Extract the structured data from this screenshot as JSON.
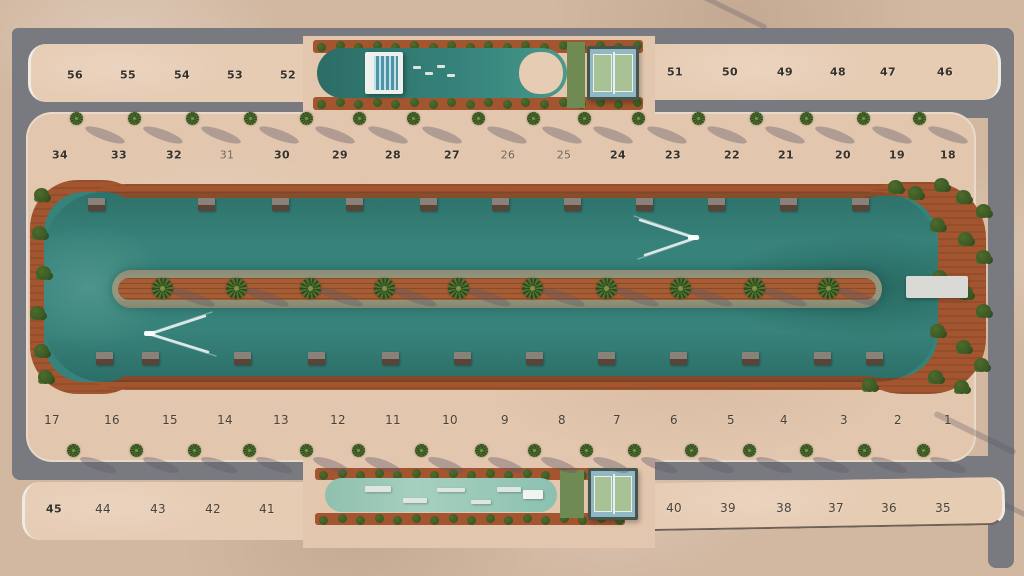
{
  "site": {
    "description": "aerial master plan of a lagoon resort community with numbered lots",
    "colors": {
      "sand_outer": "#d2b8a1",
      "sand_block": "#e7ccb4",
      "sand_strip": "#e2c6ad",
      "road": "#797a80",
      "path": "#bdbec2",
      "curb": "#efece6",
      "deck": "#a2552f",
      "water": "#37827a",
      "island_edge": "#95967f",
      "island_core": "#a65d33",
      "palm_dark": "#2c491f",
      "palm_light": "#55722f",
      "shrub_dark": "#32501f",
      "shrub_light": "#4e6c2c",
      "lawn": "#6f8a52",
      "court_blue": "#8fb8c4",
      "court_green": "#a9c295",
      "court_line": "#e9f1ef",
      "court_frame": "#46544c",
      "dock_top": "#8a8278",
      "dock_base": "#5a4337",
      "pier": "#d9d9d5",
      "wake": "#ffffff",
      "wakepool": "#97c7b6",
      "num_dark": "#36322c",
      "num_mid": "#4a4138",
      "num_soft": "#6e6257",
      "shadow": "rgba(95,90,102,0.38)"
    },
    "lot_rows": [
      {
        "name": "north-outer-west",
        "style": "bold",
        "y": 75,
        "lots": [
          {
            "n": "56",
            "x": 75
          },
          {
            "n": "55",
            "x": 128
          },
          {
            "n": "54",
            "x": 182
          },
          {
            "n": "53",
            "x": 235
          },
          {
            "n": "52",
            "x": 288
          }
        ]
      },
      {
        "name": "north-outer-east",
        "style": "bold",
        "y": 72,
        "lots": [
          {
            "n": "51",
            "x": 675
          },
          {
            "n": "50",
            "x": 730
          },
          {
            "n": "49",
            "x": 785
          },
          {
            "n": "48",
            "x": 838
          },
          {
            "n": "47",
            "x": 888
          },
          {
            "n": "46",
            "x": 945
          }
        ]
      },
      {
        "name": "north-inner",
        "style": "bold",
        "y": 155,
        "lots": [
          {
            "n": "34",
            "x": 60
          },
          {
            "n": "33",
            "x": 119
          },
          {
            "n": "32",
            "x": 174
          },
          {
            "n": "31",
            "x": 227,
            "style": "soft"
          },
          {
            "n": "30",
            "x": 282
          },
          {
            "n": "29",
            "x": 340
          },
          {
            "n": "28",
            "x": 393
          },
          {
            "n": "27",
            "x": 452
          },
          {
            "n": "26",
            "x": 508,
            "style": "soft"
          },
          {
            "n": "25",
            "x": 564,
            "style": "soft"
          },
          {
            "n": "24",
            "x": 618
          },
          {
            "n": "23",
            "x": 673
          },
          {
            "n": "22",
            "x": 732
          },
          {
            "n": "21",
            "x": 786
          },
          {
            "n": "20",
            "x": 843
          },
          {
            "n": "19",
            "x": 897
          },
          {
            "n": "18",
            "x": 948
          }
        ]
      },
      {
        "name": "south-inner",
        "style": "mid",
        "y": 420,
        "lots": [
          {
            "n": "17",
            "x": 52
          },
          {
            "n": "16",
            "x": 112
          },
          {
            "n": "15",
            "x": 170
          },
          {
            "n": "14",
            "x": 225
          },
          {
            "n": "13",
            "x": 281
          },
          {
            "n": "12",
            "x": 338
          },
          {
            "n": "11",
            "x": 393
          },
          {
            "n": "10",
            "x": 450
          },
          {
            "n": "9",
            "x": 505
          },
          {
            "n": "8",
            "x": 562
          },
          {
            "n": "7",
            "x": 617
          },
          {
            "n": "6",
            "x": 674
          },
          {
            "n": "5",
            "x": 731
          },
          {
            "n": "4",
            "x": 784
          },
          {
            "n": "3",
            "x": 844
          },
          {
            "n": "2",
            "x": 898
          },
          {
            "n": "1",
            "x": 948
          }
        ]
      },
      {
        "name": "south-outer-west",
        "style": "mid",
        "y": 509,
        "lots": [
          {
            "n": "45",
            "x": 54,
            "style": "bold"
          },
          {
            "n": "44",
            "x": 103
          },
          {
            "n": "43",
            "x": 158
          },
          {
            "n": "42",
            "x": 213
          },
          {
            "n": "41",
            "x": 267
          }
        ]
      },
      {
        "name": "south-outer-east",
        "style": "mid",
        "y": 508,
        "lots": [
          {
            "n": "40",
            "x": 674
          },
          {
            "n": "39",
            "x": 728
          },
          {
            "n": "38",
            "x": 784
          },
          {
            "n": "37",
            "x": 836
          },
          {
            "n": "36",
            "x": 889
          },
          {
            "n": "35",
            "x": 943
          }
        ]
      }
    ]
  }
}
